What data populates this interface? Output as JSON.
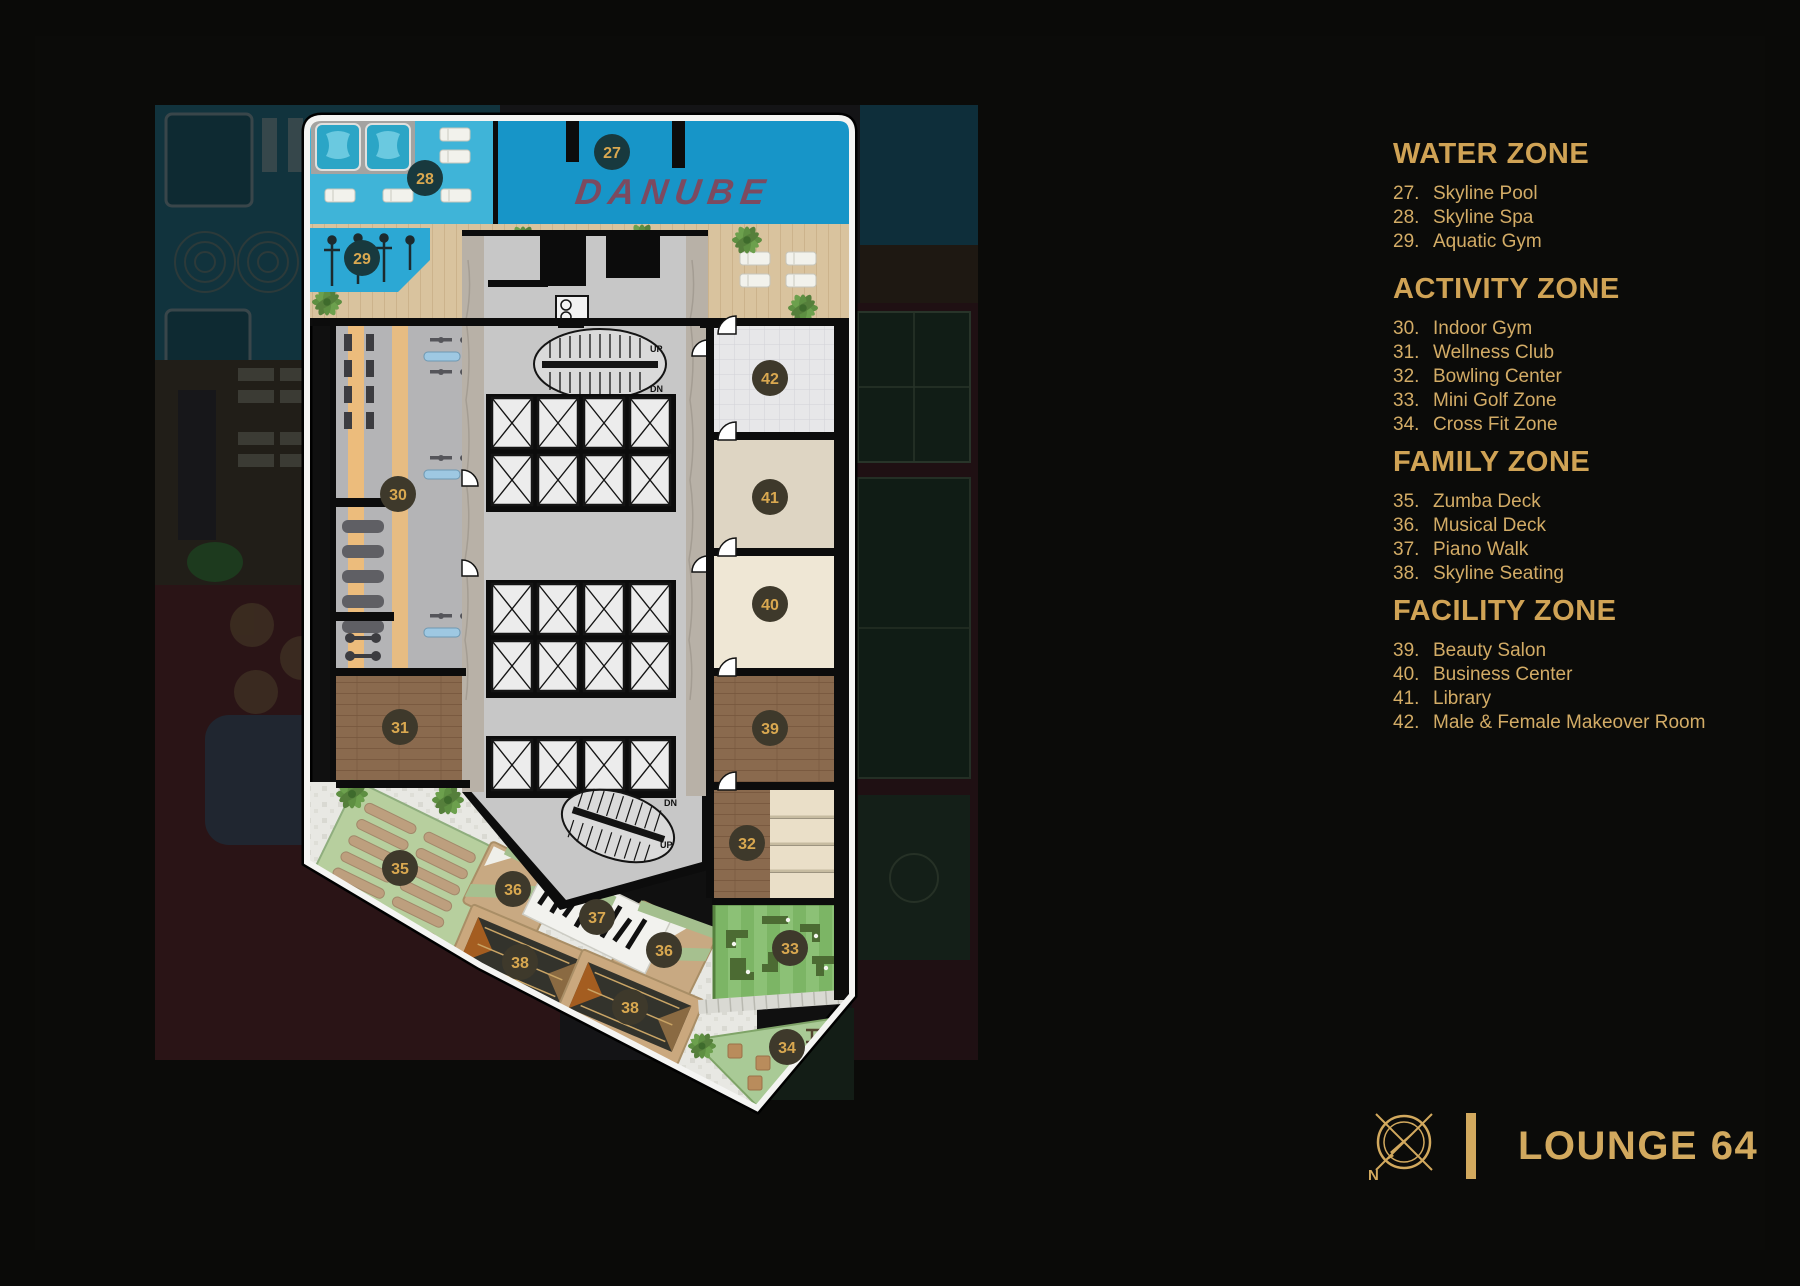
{
  "colors": {
    "accent_gold": "#D2A95E",
    "slide_bg": "#0A0A08",
    "pool_blue": "#1795C8",
    "spa_blue": "#3FB4D8",
    "aquatic_blue": "#2CA8D4",
    "danube_red": "#8E3E4E",
    "badge_dark": "#3E392B",
    "badge_water": "#18393E",
    "deck_tan": "#D9C39E",
    "room_wood": "#8A6A4E",
    "lawn_green": "#7CB565"
  },
  "plan": {
    "watermark": "DANUBE",
    "stairs": {
      "up": "UP",
      "dn": "DN"
    },
    "badges": {
      "b27": "27",
      "b28": "28",
      "b29": "29",
      "b30": "30",
      "b31": "31",
      "b32": "32",
      "b33": "33",
      "b34": "34",
      "b35": "35",
      "b36": "36",
      "b37": "37",
      "b38": "38",
      "b39": "39",
      "b40": "40",
      "b41": "41",
      "b42": "42"
    }
  },
  "legend": {
    "sections": [
      {
        "title": "WATER ZONE",
        "items": [
          {
            "num": "27.",
            "label": "Skyline Pool"
          },
          {
            "num": "28.",
            "label": "Skyline Spa"
          },
          {
            "num": "29.",
            "label": "Aquatic Gym"
          }
        ]
      },
      {
        "title": "ACTIVITY ZONE",
        "items": [
          {
            "num": "30.",
            "label": "Indoor Gym"
          },
          {
            "num": "31.",
            "label": "Wellness Club"
          },
          {
            "num": "32.",
            "label": "Bowling Center"
          },
          {
            "num": "33.",
            "label": "Mini Golf Zone"
          },
          {
            "num": "34.",
            "label": "Cross Fit Zone"
          }
        ]
      },
      {
        "title": "FAMILY ZONE",
        "items": [
          {
            "num": "35.",
            "label": "Zumba Deck"
          },
          {
            "num": "36.",
            "label": "Musical Deck"
          },
          {
            "num": "37.",
            "label": "Piano Walk"
          },
          {
            "num": "38.",
            "label": "Skyline Seating"
          }
        ]
      },
      {
        "title": "FACILITY ZONE",
        "items": [
          {
            "num": "39.",
            "label": "Beauty Salon"
          },
          {
            "num": "40.",
            "label": "Business Center"
          },
          {
            "num": "41.",
            "label": "Library"
          },
          {
            "num": "42.",
            "label": "Male & Female Makeover Room"
          }
        ]
      }
    ]
  },
  "footer": {
    "north": "N",
    "title": "LOUNGE 64"
  }
}
